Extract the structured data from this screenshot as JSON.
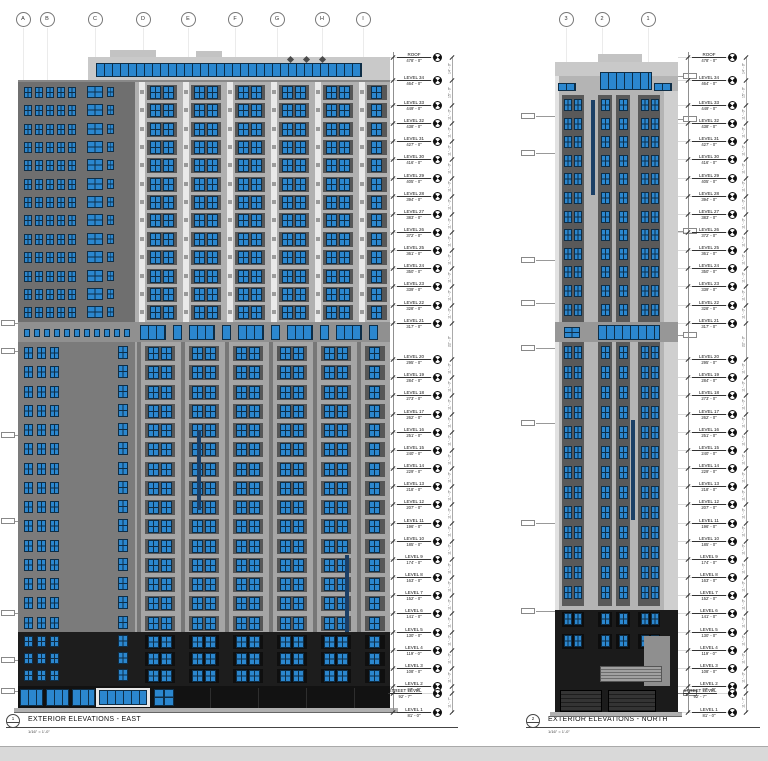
{
  "east": {
    "title": "EXTERIOR ELEVATIONS - EAST",
    "scale_label": "1/16\" = 1'-0\"",
    "tag": "1",
    "sign_pre": "THE",
    "sign_m": "M",
    "sign_post": "ARK",
    "grid_bubbles": [
      {
        "label": "A",
        "x": 23
      },
      {
        "label": "B",
        "x": 47
      },
      {
        "label": "C",
        "x": 95
      },
      {
        "label": "D",
        "x": 143
      },
      {
        "label": "E",
        "x": 188
      },
      {
        "label": "F",
        "x": 235
      },
      {
        "label": "G",
        "x": 277
      },
      {
        "label": "H",
        "x": 322
      },
      {
        "label": "I",
        "x": 363
      }
    ]
  },
  "north": {
    "title": "EXTERIOR ELEVATIONS - NORTH",
    "scale_label": "1/16\" = 1'-0\"",
    "tag": "2",
    "grid_bubbles": [
      {
        "label": "3",
        "x": 566
      },
      {
        "label": "2",
        "x": 602
      },
      {
        "label": "1",
        "x": 648
      }
    ]
  },
  "levels": [
    {
      "name": "ROOF",
      "elev": "478' - 0\"",
      "ft": 478
    },
    {
      "name": "LEVEL 34",
      "elev": "464' - 0\"",
      "ft": 464
    },
    {
      "name": "LEVEL 33",
      "elev": "449' - 0\"",
      "ft": 449
    },
    {
      "name": "LEVEL 32",
      "elev": "438' - 0\"",
      "ft": 438
    },
    {
      "name": "LEVEL 31",
      "elev": "427' - 0\"",
      "ft": 427
    },
    {
      "name": "LEVEL 30",
      "elev": "416' - 0\"",
      "ft": 416
    },
    {
      "name": "LEVEL 29",
      "elev": "405' - 0\"",
      "ft": 405
    },
    {
      "name": "LEVEL 28",
      "elev": "394' - 0\"",
      "ft": 394
    },
    {
      "name": "LEVEL 27",
      "elev": "383' - 0\"",
      "ft": 383
    },
    {
      "name": "LEVEL 26",
      "elev": "372' - 0\"",
      "ft": 372
    },
    {
      "name": "LEVEL 25",
      "elev": "361' - 0\"",
      "ft": 361
    },
    {
      "name": "LEVEL 24",
      "elev": "350' - 0\"",
      "ft": 350
    },
    {
      "name": "LEVEL 23",
      "elev": "339' - 0\"",
      "ft": 339
    },
    {
      "name": "LEVEL 22",
      "elev": "328' - 0\"",
      "ft": 328
    },
    {
      "name": "LEVEL 21",
      "elev": "317' - 0\"",
      "ft": 317
    },
    {
      "name": "LEVEL 20",
      "elev": "295' - 0\"",
      "ft": 295
    },
    {
      "name": "LEVEL 19",
      "elev": "284' - 0\"",
      "ft": 284
    },
    {
      "name": "LEVEL 18",
      "elev": "273' - 0\"",
      "ft": 273
    },
    {
      "name": "LEVEL 17",
      "elev": "262' - 0\"",
      "ft": 262
    },
    {
      "name": "LEVEL 16",
      "elev": "251' - 0\"",
      "ft": 251
    },
    {
      "name": "LEVEL 15",
      "elev": "240' - 0\"",
      "ft": 240
    },
    {
      "name": "LEVEL 14",
      "elev": "229' - 0\"",
      "ft": 229
    },
    {
      "name": "LEVEL 13",
      "elev": "218' - 0\"",
      "ft": 218
    },
    {
      "name": "LEVEL 12",
      "elev": "207' - 0\"",
      "ft": 207
    },
    {
      "name": "LEVEL 11",
      "elev": "196' - 0\"",
      "ft": 196
    },
    {
      "name": "LEVEL 10",
      "elev": "185' - 0\"",
      "ft": 185
    },
    {
      "name": "LEVEL 9",
      "elev": "174' - 0\"",
      "ft": 174
    },
    {
      "name": "LEVEL 8",
      "elev": "163' - 0\"",
      "ft": 163
    },
    {
      "name": "LEVEL 7",
      "elev": "152' - 0\"",
      "ft": 152
    },
    {
      "name": "LEVEL 6",
      "elev": "141' - 0\"",
      "ft": 141
    },
    {
      "name": "LEVEL 5",
      "elev": "130' - 0\"",
      "ft": 130
    },
    {
      "name": "LEVEL 4",
      "elev": "119' - 0\"",
      "ft": 119
    },
    {
      "name": "LEVEL 3",
      "elev": "108' - 0\"",
      "ft": 108
    },
    {
      "name": "LEVEL 2",
      "elev": "97' - 0\"",
      "ft": 97
    },
    {
      "name": "STREET LEVEL",
      "elev": "92' - 7\"",
      "ft": 92.58
    },
    {
      "name": "LEVEL 1",
      "elev": "81' - 0\"",
      "ft": 81
    }
  ],
  "icons": {
    "datum_target": "spot-elevation-target",
    "grid_bubble": "column-grid-bubble"
  },
  "colors": {
    "window_blue": "#2b87cf",
    "window_frame": "#0e2e47",
    "panel_light": "#c9c9c9",
    "panel_mid": "#b0b0b0",
    "panel_dark": "#6f6f6f",
    "stack_dark": "#575757",
    "base_black": "#1d1d1d",
    "street_black": "#121212",
    "accent_navy": "#1b3f66",
    "ground": "#b0b0b0",
    "pilaster_white": "#e9e9e9"
  }
}
